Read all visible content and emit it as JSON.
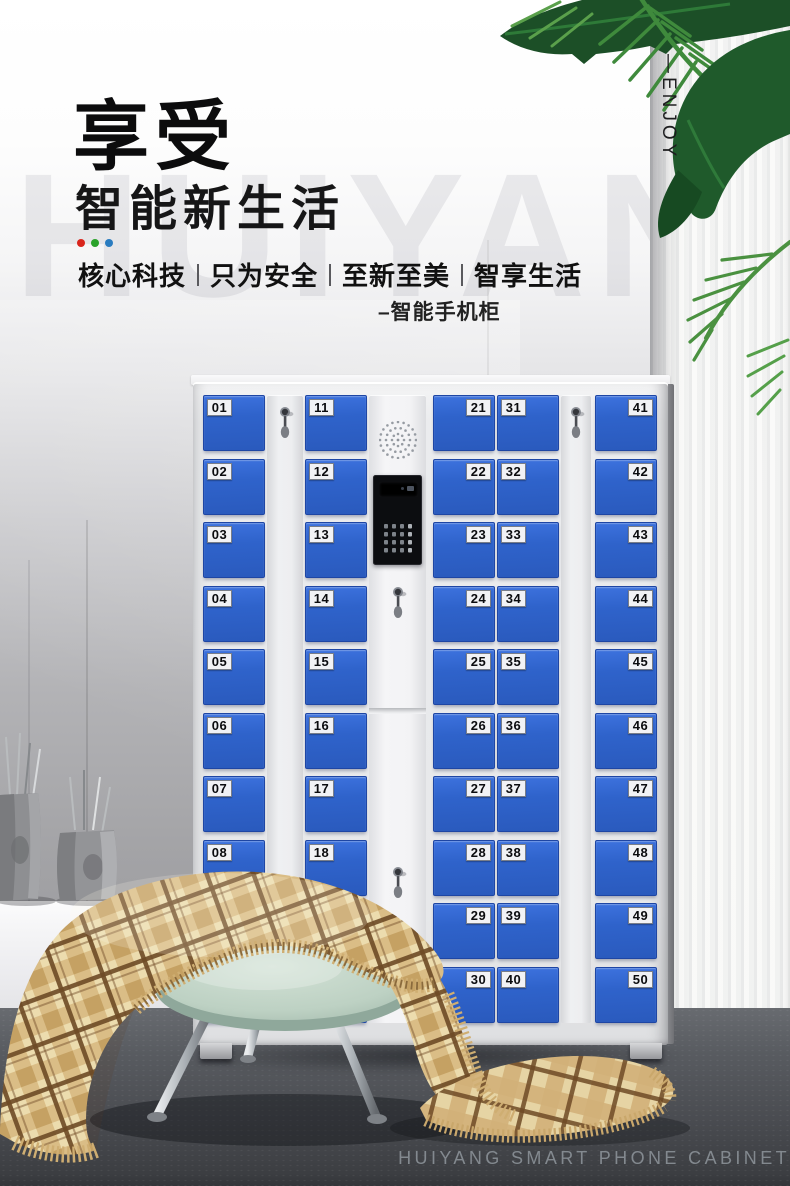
{
  "header": {
    "title": "享受",
    "subtitle": "智能新生活",
    "dot_colors": [
      "#d9251c",
      "#2aa22a",
      "#2a7cc0"
    ],
    "tagline_items": [
      "核心科技",
      "只为安全",
      "至新至美",
      "智享生活"
    ],
    "product_label": "–智能手机柜"
  },
  "decor": {
    "vertical_text": "—ENJOY",
    "watermark_text": "HUIYANG",
    "bottom_caption": "HUIYANG SMART PHONE CABINET"
  },
  "cabinet": {
    "door_color": "#2f63cb",
    "body_color": "#eaebed",
    "occluded_door_numbers": [
      "09",
      "10",
      "20"
    ],
    "columns": [
      {
        "kind": "doors",
        "plate_side": "left",
        "numbers": [
          "01",
          "02",
          "03",
          "04",
          "05",
          "06",
          "07",
          "08",
          "09",
          "10"
        ]
      },
      {
        "kind": "lock-strip"
      },
      {
        "kind": "doors",
        "plate_side": "left",
        "numbers": [
          "11",
          "12",
          "13",
          "14",
          "15",
          "16",
          "17",
          "18",
          "19",
          "20"
        ]
      },
      {
        "kind": "control-panel"
      },
      {
        "kind": "doors",
        "plate_side": "right",
        "numbers": [
          "21",
          "22",
          "23",
          "24",
          "25",
          "26",
          "27",
          "28",
          "29",
          "30"
        ]
      },
      {
        "kind": "doors",
        "plate_side": "left",
        "numbers": [
          "31",
          "32",
          "33",
          "34",
          "35",
          "36",
          "37",
          "38",
          "39",
          "40"
        ]
      },
      {
        "kind": "lock-strip"
      },
      {
        "kind": "doors",
        "plate_side": "right",
        "numbers": [
          "41",
          "42",
          "43",
          "44",
          "45",
          "46",
          "47",
          "48",
          "49",
          "50"
        ]
      }
    ]
  },
  "scene_colors": {
    "wall": "#a5a5a8",
    "floor": "#54575c",
    "blanket_cream": "#ecdcae",
    "blanket_tan": "#d9ba82",
    "blanket_brown": "#6e4a26",
    "stool_seat": "#c5d8cb",
    "leaf_dark": "#1c4f27",
    "leaf_mid": "#3f8a3c"
  }
}
